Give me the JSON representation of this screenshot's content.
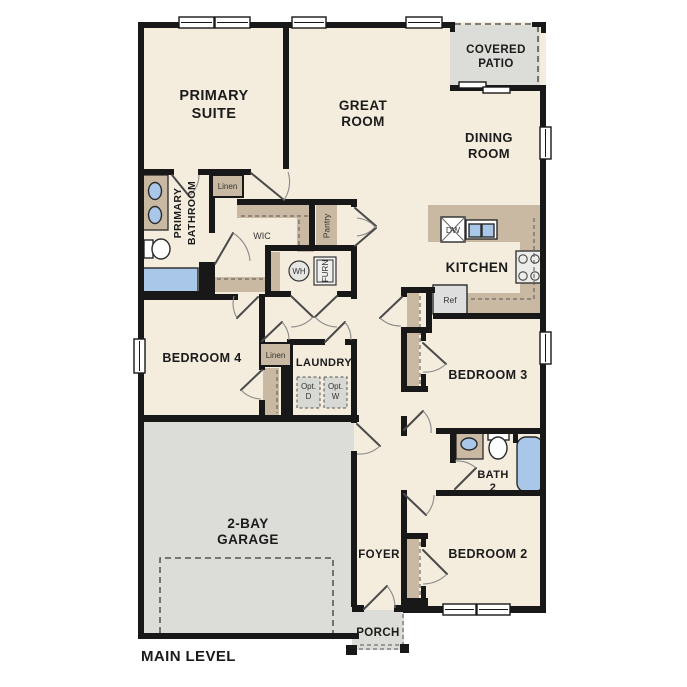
{
  "title": "MAIN LEVEL",
  "colors": {
    "floor": "#f4ecdc",
    "wall": "#181818",
    "cabinet_tan": "#c9b9a2",
    "area_gray": "#dcdcd8",
    "fixture_blue": "#a9c7e8",
    "appliance_gray": "#dedede"
  },
  "rooms": {
    "primary_suite": {
      "line1": "PRIMARY",
      "line2": "SUITE"
    },
    "great_room": {
      "line1": "GREAT",
      "line2": "ROOM"
    },
    "covered_patio": {
      "line1": "COVERED",
      "line2": "PATIO"
    },
    "dining_room": {
      "line1": "DINING",
      "line2": "ROOM"
    },
    "kitchen": {
      "label": "KITCHEN"
    },
    "primary_bathroom": {
      "line1": "PRIMARY",
      "line2": "BATHROOM"
    },
    "wic": {
      "label": "WIC"
    },
    "pantry": {
      "label": "Pantry"
    },
    "laundry": {
      "label": "LAUNDRY"
    },
    "bedroom4": {
      "label": "BEDROOM 4"
    },
    "bedroom3": {
      "label": "BEDROOM 3"
    },
    "bedroom2": {
      "label": "BEDROOM 2"
    },
    "bath2": {
      "line1": "BATH",
      "line2": "2"
    },
    "foyer": {
      "label": "FOYER"
    },
    "porch": {
      "label": "PORCH"
    },
    "garage": {
      "line1": "2-BAY",
      "line2": "GARAGE"
    }
  },
  "closets": {
    "linen_upper": "Linen",
    "linen_hall": "Linen"
  },
  "equipment": {
    "water_heater": "WH",
    "furnace": "FURN",
    "dishwasher": "DW",
    "refrigerator": "Ref",
    "opt_dryer_line1": "Opt.",
    "opt_dryer_line2": "D",
    "opt_washer_line1": "Opt.",
    "opt_washer_line2": "W"
  }
}
